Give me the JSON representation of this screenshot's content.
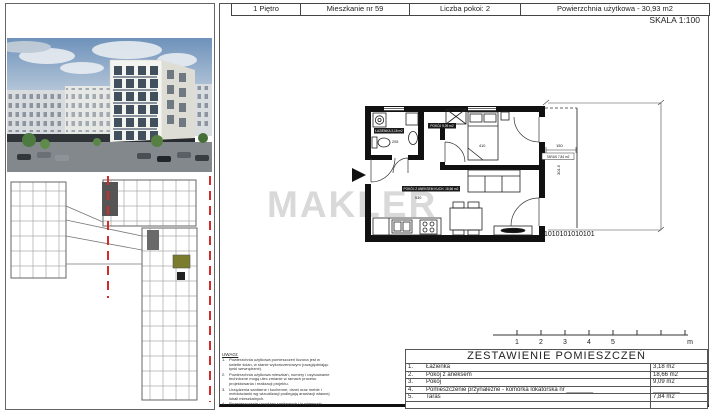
{
  "header": {
    "cells": [
      "1 Piętro",
      "Mieszkanie nr 59",
      "Liczba pokoi: 2",
      "Powierzchnia użytkowa - 30,93 m2"
    ],
    "scale": "SKALA 1:100"
  },
  "watermark": "MAKLER",
  "plan": {
    "rooms": [
      {
        "label": "ŁAZIENKA 3,18 m2"
      },
      {
        "label": "POKÓJ 9,09 m2"
      },
      {
        "label": "POKÓJ Z ANEKSEM KUCH. 18,66 m2"
      },
      {
        "label": "TARAS 7,84 m2"
      }
    ],
    "dims": {
      "hall": "205",
      "bedroom": "410",
      "living": "530",
      "terrace_width": "150",
      "terrace_height": "301.5"
    },
    "railing": "1010101010101"
  },
  "scale_bar": {
    "ticks": [
      "1",
      "2",
      "3",
      "4",
      "5"
    ],
    "unit": "m"
  },
  "summary": {
    "title": "ZESTAWIENIE POMIESZCZEŃ",
    "rows": [
      {
        "no": "1.",
        "name": "Łazienka",
        "area": "3,18 m2"
      },
      {
        "no": "2.",
        "name": "Pokój z aneksem",
        "area": "18,66 m2"
      },
      {
        "no": "3.",
        "name": "Pokój",
        "area": "9,09 m2"
      },
      {
        "no": "4.",
        "name": "Pomieszczenie przynależne - komórka lokatorska nr ________",
        "area": "________"
      },
      {
        "no": "5.",
        "name": "Taras",
        "area": "7,84 m2"
      },
      {
        "no": "",
        "name": "",
        "area": ""
      }
    ]
  },
  "notes": {
    "title": "UWAGI:",
    "items": [
      "Powierzchnia użytkowa pomieszczeń liczona jest w świetle ścian, w stanie wykończeniowym (uwzględniając tynki wewnętrzne).",
      "Powierzchnia użytkowa mieszkań, numery i usytuowanie techniczne mogą ulec zmianie w ramach procesu projektowania i realizacji projektu.",
      "Urządzenia sanitarne i kuchenne, drzwi oraz meble i meblościanki wg wizualizacji podlegają aranżacji własnej lokali mieszkalnych.",
      "Rozmieszczenie urządzeń sanitarnych i kuchennych."
    ]
  }
}
